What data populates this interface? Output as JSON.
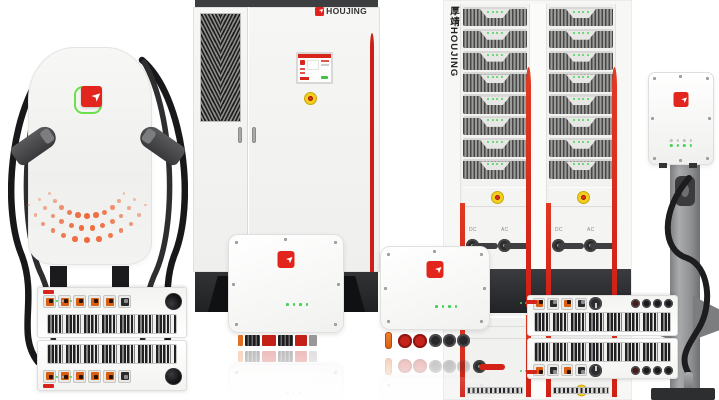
{
  "brand": {
    "name": "HOUJING",
    "vertical_label": "厚靖HOUJING"
  },
  "icons": {
    "logo_arrow": "➤"
  },
  "colors": {
    "brand_red": "#e2231d",
    "stripe_red": "#cf2016",
    "logo_green": "#6be04b",
    "led_green": "#46d455",
    "smile_orange": "#ee6a3c",
    "connector_orange": "#d95f12",
    "estop_yellow": "#f2cf1f",
    "estop_red": "#e03419",
    "cable_dark": "#1c1c1e",
    "base_dark": "#2a2c2e"
  },
  "rack": {
    "vertical_label": "厚靖HOUJING",
    "columns": 2,
    "modules_per_column": 8,
    "leds_per_module": 4,
    "switch_labels": [
      "DC",
      "AC"
    ]
  },
  "cabinet": {
    "logo_text": "HOUJING"
  },
  "pillar": {
    "smile": {
      "color": "#ee6a3c",
      "center_x": 79,
      "center_y": 158,
      "start_deg": 28,
      "end_deg": 152,
      "arcs": [
        {
          "radius": 42,
          "count": 11
        },
        {
          "radius": 54,
          "count": 12
        },
        {
          "radius": 66,
          "count": 13
        }
      ]
    }
  },
  "inverter_box_center": {
    "connector_blocks": [
      [
        "#e07020",
        5
      ],
      [
        "striped",
        15
      ],
      [
        "#c32017",
        14
      ],
      [
        "striped",
        15
      ],
      [
        "#c32017",
        12
      ],
      [
        "#97979a",
        8
      ]
    ]
  }
}
